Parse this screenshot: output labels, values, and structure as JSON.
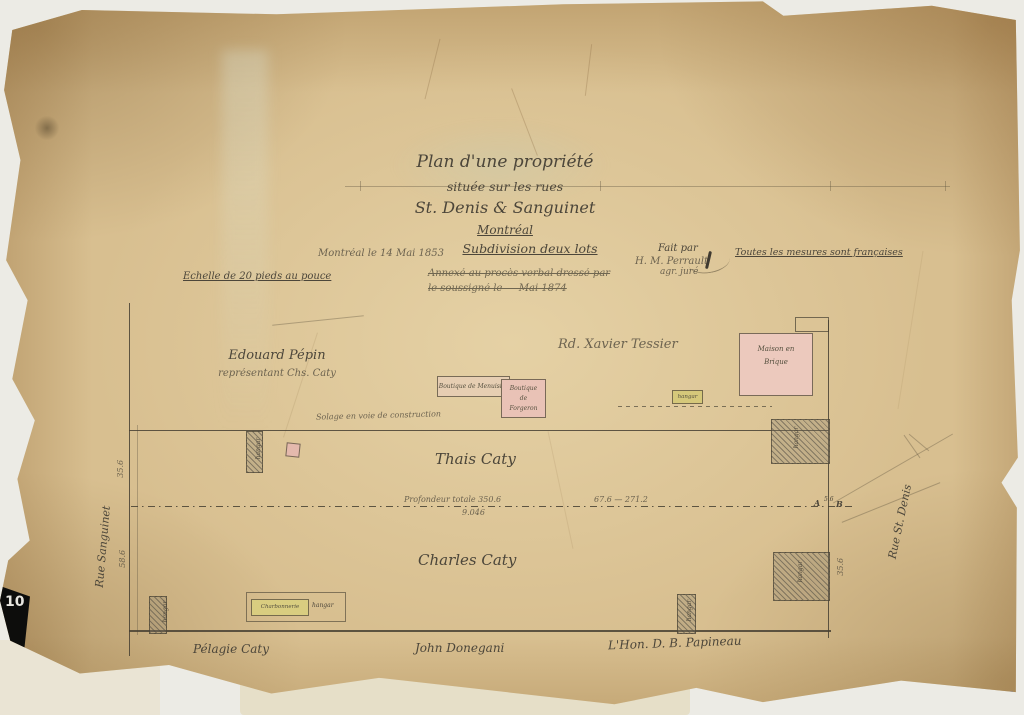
{
  "page": {
    "corner_number": "10",
    "corner_stamp": "811"
  },
  "title_block": {
    "title_line1": "Plan d'une propriété",
    "title_line2": "située sur les rues",
    "title_line3": "St. Denis & Sanguinet",
    "title_line4": "Montréal",
    "subdivision": "Subdivision deux lots",
    "date_note": "Montréal le 14 Mai 1853",
    "fait_par": "Fait par",
    "surveyor_name": "H. M. Perrault",
    "surveyor_title": "agr. juré",
    "struck_line1": "Annexé au procès verbal dressé par",
    "struck_line2": "le soussigné le — Mai 1874",
    "scale_note": "Echelle de 20 pieds au pouce",
    "measures_note": "Toutes les mesures sont françaises"
  },
  "plan": {
    "streets": {
      "left": "Rue Sanguinet",
      "right": "Rue St. Denis"
    },
    "parcels": {
      "upper_left_owner": "Edouard Pépin",
      "upper_left_sub": "représentant Chs. Caty",
      "upper_right_owner": "Rd. Xavier Tessier",
      "middle_owner": "Thais Caty",
      "lower_owner": "Charles Caty",
      "south_left": "Pélagie Caty",
      "south_center": "John Donegani",
      "south_right": "L'Hon. D. B. Papineau"
    },
    "buildings": {
      "menuisier": "Boutique de Menuisier",
      "forgeron": "Boutique de Forgeron",
      "maison_brique": "Maison en Brique",
      "hangar": "hangar",
      "charbonnerie": "Charbonnerie"
    },
    "notes": {
      "construction": "Solage en voie de construction"
    },
    "dimensions": {
      "depth_total": "Profondeur totale 350.6",
      "depth_sub": "9.046",
      "segment": "67.6 — 271.2",
      "point_a": "A",
      "point_ab_frac": "5.6",
      "point_b": "B",
      "left_upper": "35.6",
      "left_lower": "58.6",
      "right_lower": "35.6"
    }
  },
  "colors": {
    "paper": "#d8bf90",
    "ink": "#4c463a",
    "building_pink": "#eac6ba",
    "building_yellow": "#d6ca7c"
  }
}
